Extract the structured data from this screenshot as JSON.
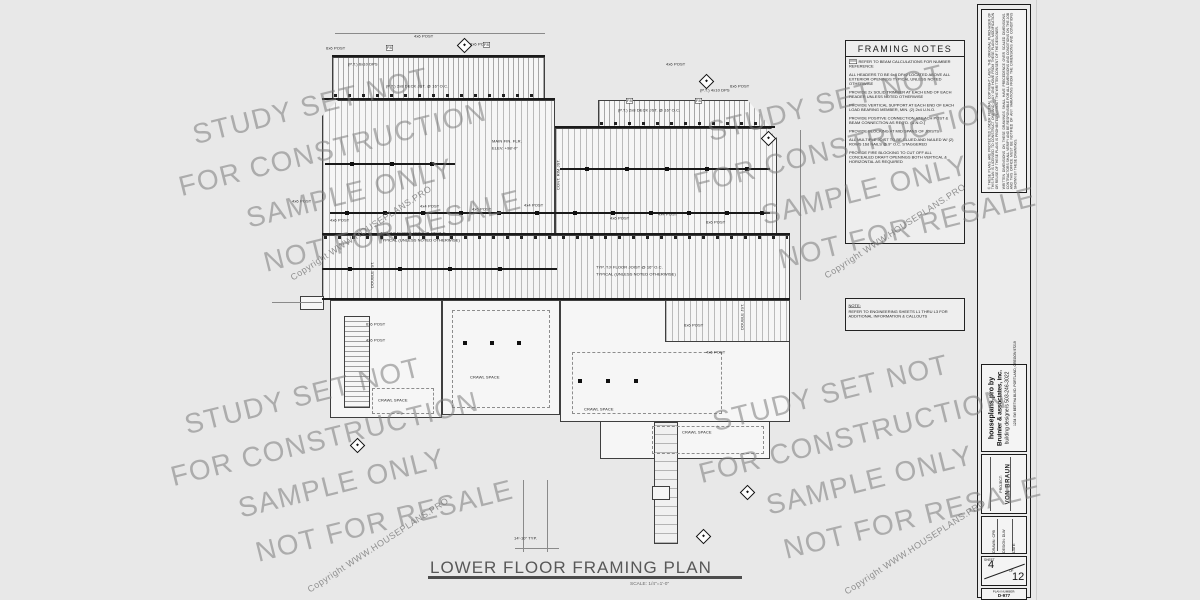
{
  "sheet": {
    "title": "LOWER FLOOR FRAMING PLAN",
    "scale": "SCALE: 1/4\"=1'-0\""
  },
  "watermark": {
    "lines": [
      "STUDY SET NOT",
      "FOR CONSTRUCTION",
      "SAMPLE ONLY",
      "NOT FOR RESALE"
    ],
    "copyright": "Copyright WWW.HOUSEPLANS.PRO"
  },
  "framing_notes": {
    "title": "FRAMING NOTES",
    "tag": "XXX",
    "notes": [
      "REFER TO BEAM CALCULATIONS FOR NUMBER REFERENCE",
      "ALL HEADERS TO BE 6x8 DF#2 LOCATED ABOVE ALL EXTERIOR OPENINGS TYPICAL UNLESS NOTED OTHERWISE",
      "PROVIDE 2x SOLID TRIMMER AT EACH END OF EACH HEADER UNLESS NOTED OTHERWISE",
      "PROVIDE VERTICAL SUPPORT AT EACH END OF EACH LOAD BEARING MEMBER, MIN. (2) 2x4 U.N.O.",
      "PROVIDE POSITIVE CONNECTION AT EACH POST & BEAM CONNECTION AS REQ'D. (U.N.O.)",
      "PROVIDE BLOCKING AT MID SPANS OF JOISTS",
      "ALL MULTIPLE JOIST TO BE GLUED AND NAILED W/ (2) ROWS 16d NAILS @ 9\" O.C. STAGGERED",
      "PROVIDE FIRE BLOCKING TO CUT OFF ALL CONCEALED DRAFT OPENINGS BOTH VERTICAL & HORIZONTAL AS REQUIRED"
    ]
  },
  "note_box": {
    "title": "NOTE:",
    "body": "REFER TO ENGINEERING SHEETS L1 THRU L3 FOR ADDITIONAL INFORMATION & CALLOUTS"
  },
  "titleblock": {
    "legal_1": "© THESE PLANS ARE PROTECTED UNDER FEDERAL COPYRIGHT LAWS. THE ORIGINAL PURCHASER OF THIS PLAN IS LICENSED TO CONSTRUCT ONE AND ONLY ONE HOME FROM THESE PLANS. MODIFICATION OR REUSE OF THESE PLANS IS PROHIBITED WITHOUT THE WRITTEN CONSENT OF THE DESIGNER.",
    "legal_2": "WRITTEN DIMENSIONS ON THESE DRAWINGS SHALL HAVE PRECEDENCE OVER SCALED DIMENSIONS. CONTRACTORS SHALL VERIFY AND BE RESPONSIBLE FOR ALL DIMENSIONS AND CONDITIONS ON THE JOB AND THIS OFFICE MUST BE NOTIFIED OF ANY VARIATIONS FROM THE DIMENSIONS AND CONDITIONS SHOWN BY THESE DRAWINGS.",
    "firm_line1": "houseplans.pro by",
    "firm_line2": "Bruinier & associates, inc.",
    "firm_line3": "building designers 503-246-3022",
    "firm_line4": "1234 SW BERTHA BLVD. PORTLAND, OREGON 97219",
    "project_label": "PROJECT:",
    "project_value": "VON BRAUN",
    "drawn_field": "DRAWN:  CPB",
    "design_field": "DESIGN:  DLW",
    "date_field": "DATE:",
    "sheet_label": "SHEET",
    "sheet_number": "4",
    "of_label": "OF",
    "sheet_total": "12",
    "plan_number_label": "PLAN NUMBER:",
    "plan_number": "D-977"
  },
  "plan": {
    "labels": [
      {
        "t": "(P.T.) 2x8 DECK JST. @ 16\" O.C.",
        "x": 386,
        "y": 84
      },
      {
        "t": "(P.T.) 2x8 DECK JST. @ 16\" O.C.",
        "x": 618,
        "y": 108
      },
      {
        "t": "(P.T.) 6x10 DPS",
        "x": 348,
        "y": 62
      },
      {
        "t": "(P.T.) 4x10 DPS",
        "x": 700,
        "y": 88
      },
      {
        "t": "6x6 POST",
        "x": 326,
        "y": 46
      },
      {
        "t": "4x6 POST",
        "x": 414,
        "y": 34
      },
      {
        "t": "6x6 POST",
        "x": 470,
        "y": 42
      },
      {
        "t": "4x6 POST",
        "x": 666,
        "y": 62
      },
      {
        "t": "6x6 POST",
        "x": 730,
        "y": 84
      },
      {
        "t": "MAIN FIN. FLR.",
        "x": 492,
        "y": 139
      },
      {
        "t": "ELEV. +98'-0\"",
        "x": 492,
        "y": 146
      },
      {
        "t": "TYP. TJI FLOOR JOIST @ 16\" O.C.",
        "x": 380,
        "y": 231
      },
      {
        "t": "TYPICAL (UNLESS NOTED OTHERWISE)",
        "x": 380,
        "y": 238
      },
      {
        "t": "TYP. TJI FLOOR JOIST @ 16\" O.C.",
        "x": 596,
        "y": 265
      },
      {
        "t": "TYPICAL (UNLESS NOTED OTHERWISE)",
        "x": 596,
        "y": 272
      },
      {
        "t": "DOUBLE JST.",
        "x": 370,
        "y": 288,
        "r": -90
      },
      {
        "t": "DOUBLE JST.",
        "x": 740,
        "y": 330,
        "r": -90
      },
      {
        "t": "CONT. RIM JST.",
        "x": 556,
        "y": 190,
        "r": -90
      },
      {
        "t": "CRAWL SPACE",
        "x": 378,
        "y": 398
      },
      {
        "t": "CRAWL SPACE",
        "x": 470,
        "y": 375
      },
      {
        "t": "CRAWL SPACE",
        "x": 584,
        "y": 407
      },
      {
        "t": "CRAWL SPACE",
        "x": 682,
        "y": 430
      },
      {
        "t": "4x6 POST",
        "x": 292,
        "y": 199
      },
      {
        "t": "4x6 POST",
        "x": 330,
        "y": 218
      },
      {
        "t": "4x4 POST",
        "x": 420,
        "y": 204
      },
      {
        "t": "4x6 POST",
        "x": 472,
        "y": 207
      },
      {
        "t": "4x4 POST",
        "x": 524,
        "y": 203
      },
      {
        "t": "4x6 POST",
        "x": 610,
        "y": 216
      },
      {
        "t": "4x4 POST",
        "x": 658,
        "y": 212
      },
      {
        "t": "6x6 POST",
        "x": 706,
        "y": 220
      },
      {
        "t": "6x6 POST",
        "x": 366,
        "y": 322
      },
      {
        "t": "4x6 POST",
        "x": 366,
        "y": 338
      },
      {
        "t": "6x6 POST",
        "x": 684,
        "y": 323
      },
      {
        "t": "4x6 POST",
        "x": 706,
        "y": 350
      },
      {
        "t": "14'-10\" TYP.",
        "x": 514,
        "y": 536
      },
      {
        "t": "F8",
        "x": 386,
        "y": 45,
        "b": true
      },
      {
        "t": "F8",
        "x": 483,
        "y": 42,
        "b": true
      },
      {
        "t": "F8",
        "x": 626,
        "y": 98,
        "b": true
      },
      {
        "t": "F8",
        "x": 695,
        "y": 98,
        "b": true
      }
    ],
    "post_rows": [
      {
        "y": 211,
        "xs": [
          345,
          383,
          421,
          459,
          497,
          535,
          573,
          611,
          649,
          687,
          725,
          760
        ]
      },
      {
        "y": 167,
        "xs": [
          585,
          625,
          665,
          705,
          745
        ]
      },
      {
        "y": 162,
        "xs": [
          350,
          390,
          430
        ]
      },
      {
        "y": 267,
        "xs": [
          348,
          398,
          448,
          498
        ]
      },
      {
        "y": 341,
        "xs": [
          463,
          490,
          517
        ]
      },
      {
        "y": 379,
        "xs": [
          578,
          606,
          634
        ]
      }
    ],
    "markers": [
      {
        "x": 459,
        "y": 40
      },
      {
        "x": 701,
        "y": 76
      },
      {
        "x": 763,
        "y": 133
      },
      {
        "x": 352,
        "y": 440
      },
      {
        "x": 742,
        "y": 487
      },
      {
        "x": 698,
        "y": 531
      }
    ]
  }
}
